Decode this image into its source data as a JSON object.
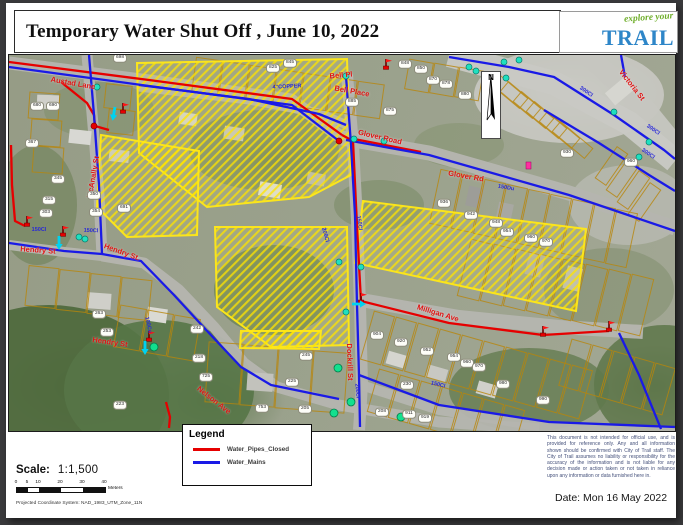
{
  "header": {
    "title": "Temporary Water Shut Off , June 10, 2022"
  },
  "logo": {
    "tagline": "explore your",
    "name": "TRAIL"
  },
  "map": {
    "north_label": "N",
    "street_labels": [
      {
        "text": "Austad Lane",
        "x": 64,
        "y": 28,
        "r": 10
      },
      {
        "text": "Bell Pl",
        "x": 332,
        "y": 20,
        "r": -5
      },
      {
        "text": "Bell Place",
        "x": 343,
        "y": 36,
        "r": 10
      },
      {
        "text": "Glover Road",
        "x": 371,
        "y": 82,
        "r": 13
      },
      {
        "text": "Glover Rd",
        "x": 457,
        "y": 121,
        "r": 10
      },
      {
        "text": "Victoria St",
        "x": 623,
        "y": 30,
        "r": 52
      },
      {
        "text": "McAnally St",
        "x": 84,
        "y": 122,
        "r": -80
      },
      {
        "text": "Hendry St",
        "x": 29,
        "y": 195,
        "r": 4
      },
      {
        "text": "Hendry St.",
        "x": 113,
        "y": 197,
        "r": 20
      },
      {
        "text": "Hendry St",
        "x": 101,
        "y": 287,
        "r": 8
      },
      {
        "text": "Nelson Ave",
        "x": 205,
        "y": 345,
        "r": 38
      },
      {
        "text": "Milligan Ave",
        "x": 429,
        "y": 258,
        "r": 17
      },
      {
        "text": "Dockrill St",
        "x": 341,
        "y": 307,
        "r": 88
      }
    ],
    "pipe_labels": [
      {
        "text": "4\"COPPER",
        "x": 278,
        "y": 32,
        "r": -3
      },
      {
        "text": "150Du",
        "x": 497,
        "y": 133,
        "r": 10
      },
      {
        "text": "300Cl",
        "x": 577,
        "y": 37,
        "r": 35
      },
      {
        "text": "300Cl",
        "x": 644,
        "y": 75,
        "r": 35
      },
      {
        "text": "300Cl",
        "x": 639,
        "y": 99,
        "r": 35
      },
      {
        "text": "150Cl",
        "x": 82,
        "y": 176,
        "r": 2
      },
      {
        "text": "150Cl",
        "x": 30,
        "y": 175,
        "r": 0
      },
      {
        "text": "100Cu",
        "x": 139,
        "y": 270,
        "r": 78
      },
      {
        "text": "200Cl",
        "x": 348,
        "y": 336,
        "r": 85
      },
      {
        "text": "150Cl",
        "x": 429,
        "y": 330,
        "r": 14
      },
      {
        "text": "200Cl",
        "x": 316,
        "y": 180,
        "r": 75
      },
      {
        "text": "150Cl",
        "x": 350,
        "y": 168,
        "r": 82
      }
    ],
    "address_labels": [
      {
        "text": "825",
        "x": 264,
        "y": 13
      },
      {
        "text": "845",
        "x": 281,
        "y": 8
      },
      {
        "text": "848",
        "x": 396,
        "y": 9
      },
      {
        "text": "850",
        "x": 412,
        "y": 14
      },
      {
        "text": "870",
        "x": 424,
        "y": 25
      },
      {
        "text": "878",
        "x": 437,
        "y": 29
      },
      {
        "text": "880",
        "x": 456,
        "y": 40
      },
      {
        "text": "885",
        "x": 343,
        "y": 47
      },
      {
        "text": "875",
        "x": 381,
        "y": 56
      },
      {
        "text": "698",
        "x": 111,
        "y": 3
      },
      {
        "text": "680",
        "x": 28,
        "y": 51
      },
      {
        "text": "690",
        "x": 44,
        "y": 51
      },
      {
        "text": "367",
        "x": 23,
        "y": 88
      },
      {
        "text": "345",
        "x": 49,
        "y": 124
      },
      {
        "text": "315",
        "x": 40,
        "y": 145
      },
      {
        "text": "303",
        "x": 37,
        "y": 158
      },
      {
        "text": "350",
        "x": 85,
        "y": 140
      },
      {
        "text": "354",
        "x": 87,
        "y": 157
      },
      {
        "text": "691",
        "x": 115,
        "y": 153
      },
      {
        "text": "263",
        "x": 90,
        "y": 259
      },
      {
        "text": "253",
        "x": 98,
        "y": 277
      },
      {
        "text": "242",
        "x": 188,
        "y": 274
      },
      {
        "text": "218",
        "x": 190,
        "y": 303
      },
      {
        "text": "725",
        "x": 197,
        "y": 322
      },
      {
        "text": "223",
        "x": 111,
        "y": 350
      },
      {
        "text": "245",
        "x": 297,
        "y": 301
      },
      {
        "text": "225",
        "x": 283,
        "y": 327
      },
      {
        "text": "753",
        "x": 253,
        "y": 353
      },
      {
        "text": "205",
        "x": 296,
        "y": 354
      },
      {
        "text": "930",
        "x": 558,
        "y": 98
      },
      {
        "text": "960",
        "x": 622,
        "y": 107
      },
      {
        "text": "936",
        "x": 435,
        "y": 148
      },
      {
        "text": "942",
        "x": 462,
        "y": 160
      },
      {
        "text": "948",
        "x": 487,
        "y": 168
      },
      {
        "text": "954",
        "x": 498,
        "y": 177
      },
      {
        "text": "960",
        "x": 522,
        "y": 183
      },
      {
        "text": "970",
        "x": 537,
        "y": 187
      },
      {
        "text": "904",
        "x": 368,
        "y": 280
      },
      {
        "text": "920",
        "x": 392,
        "y": 287
      },
      {
        "text": "952",
        "x": 418,
        "y": 296
      },
      {
        "text": "954",
        "x": 445,
        "y": 302
      },
      {
        "text": "960",
        "x": 458,
        "y": 308
      },
      {
        "text": "970",
        "x": 470,
        "y": 312
      },
      {
        "text": "911",
        "x": 400,
        "y": 359
      },
      {
        "text": "919",
        "x": 416,
        "y": 363
      },
      {
        "text": "208",
        "x": 373,
        "y": 357
      },
      {
        "text": "230",
        "x": 398,
        "y": 330
      },
      {
        "text": "980",
        "x": 494,
        "y": 329
      },
      {
        "text": "990",
        "x": 534,
        "y": 345
      }
    ]
  },
  "legend": {
    "title": "Legend",
    "items": [
      {
        "label": "Water_Pipes_Closed",
        "color": "#e60000"
      },
      {
        "label": "Water_Mains",
        "color": "#1a1ae6"
      }
    ]
  },
  "footer": {
    "scale_label": "Scale:",
    "scale_value": "1:1,500",
    "scale_ticks": [
      "0",
      "5",
      "10",
      "20",
      "30",
      "40"
    ],
    "scale_units": "Meters",
    "projection": "Projected Coordinate System:   NAD_1983_UTM_Zone_11N",
    "disclaimer": "This document is not intended for official use, and is provided for reference only. Any and all information shown should be confirmed with City of Trail staff. The City of Trail assumes no liability or responsibility for the accuracy of the information and is not liable for any decision made or action taken or not taken in reliance upon any information or data furnished here in.",
    "date": "Date: Mon 16 May 2022"
  },
  "colors": {
    "closed_pipe": "#e60000",
    "water_main": "#1a1ae6",
    "closure_highlight": "#ffe819",
    "valve": "#1fe0c0",
    "hydrant": "#ff2fa0"
  }
}
